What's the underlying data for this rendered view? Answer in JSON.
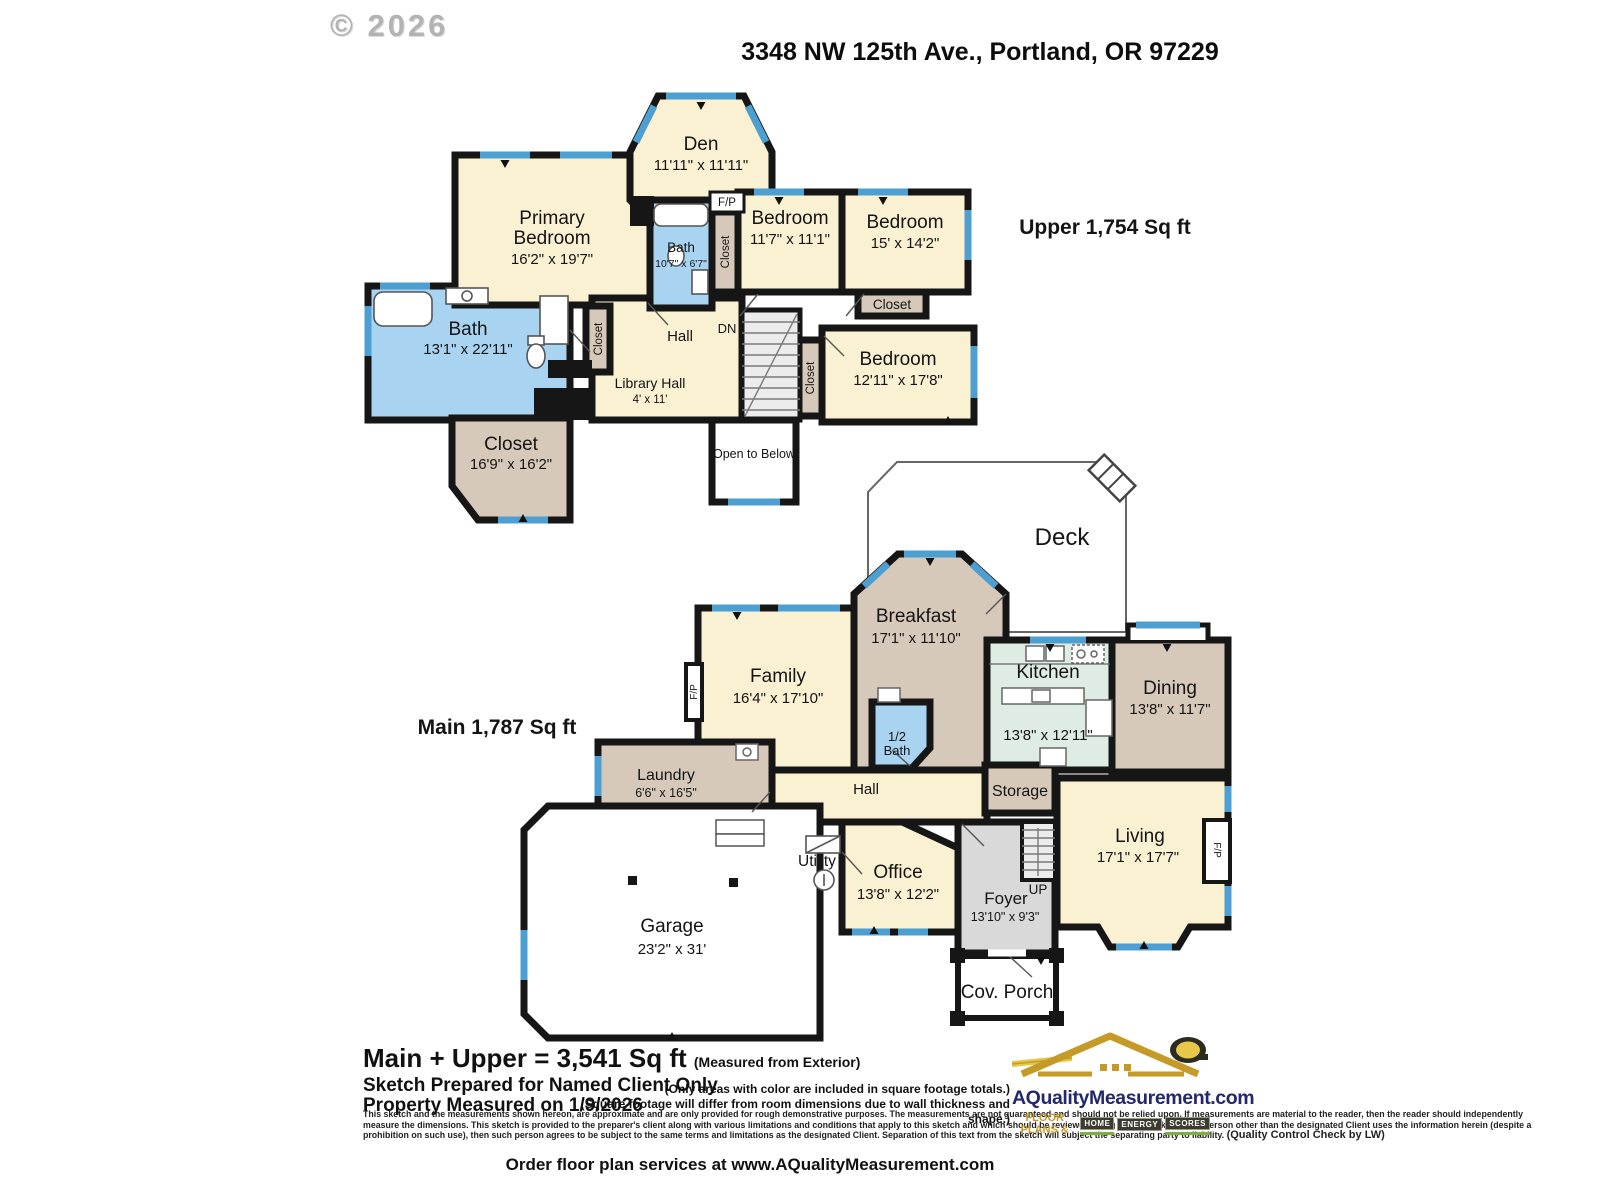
{
  "page": {
    "copyright": "© 2026",
    "address": "3348 NW 125th Ave., Portland, OR 97229",
    "order_line": "Order floor plan services at www.AQualityMeasurement.com"
  },
  "colors": {
    "room_cream": "#FAF0D2",
    "room_tan": "#D7C9B9",
    "room_blue": "#A9D4F1",
    "room_mint": "#DFECE3",
    "room_gray": "#D9D9D9",
    "stairs_gray": "#ECECEC",
    "window_blue": "#4E9FD1",
    "wall_black": "#161616",
    "logo_navy": "#23276B",
    "logo_gold": "#C59A27"
  },
  "upper": {
    "area_label": "Upper  1,754 Sq ft",
    "closet_label": "Closet",
    "dn_label": "DN",
    "fp_label": "F/P",
    "open_below": "Open to Below",
    "rooms": {
      "den": {
        "name": "Den",
        "dims": "11'11\" x 11'11\""
      },
      "primary": {
        "name1": "Primary",
        "name2": "Bedroom",
        "dims": "16'2\" x 19'7\""
      },
      "bath_small": {
        "name": "Bath",
        "dims": "10'7\" x 6'7\""
      },
      "bedroom1": {
        "name": "Bedroom",
        "dims": "11'7\" x 11'1\""
      },
      "bedroom2": {
        "name": "Bedroom",
        "dims": "15' x 14'2\""
      },
      "bedroom3": {
        "name": "Bedroom",
        "dims": "12'11\" x 17'8\""
      },
      "bath_big": {
        "name": "Bath",
        "dims": "13'1\" x 22'11\""
      },
      "hall": {
        "name": "Hall"
      },
      "library_hall": {
        "name": "Library Hall",
        "dims": "4' x 11'"
      },
      "walkin_closet": {
        "name": "Closet",
        "dims": "16'9\" x 16'2\""
      }
    }
  },
  "main": {
    "area_label": "Main  1,787 Sq ft",
    "up_label": "UP",
    "fp_label": "F/P",
    "rooms": {
      "deck": {
        "name": "Deck"
      },
      "breakfast": {
        "name": "Breakfast",
        "dims": "17'1\" x 11'10\""
      },
      "family": {
        "name": "Family",
        "dims": "16'4\" x 17'10\""
      },
      "kitchen": {
        "name": "Kitchen",
        "dims": "13'8\" x 12'11\""
      },
      "dining": {
        "name": "Dining",
        "dims": "13'8\" x 11'7\""
      },
      "half_bath": {
        "name1": "1/2",
        "name2": "Bath"
      },
      "laundry": {
        "name": "Laundry",
        "dims": "6'6\" x 16'5\""
      },
      "hall": {
        "name": "Hall"
      },
      "storage": {
        "name": "Storage"
      },
      "utility": {
        "name": "Utility"
      },
      "office": {
        "name": "Office",
        "dims": "13'8\" x 12'2\""
      },
      "foyer": {
        "name": "Foyer",
        "dims": "13'10\" x 9'3\""
      },
      "living": {
        "name": "Living",
        "dims": "17'1\" x 17'7\""
      },
      "garage": {
        "name": "Garage",
        "dims": "23'2\" x 31'"
      },
      "cov_porch": {
        "name": "Cov. Porch"
      }
    }
  },
  "footer": {
    "total": "Main + Upper = 3,541 Sq ft",
    "total_note": "(Measured from Exterior)",
    "prepared": "Sketch Prepared for Named Client Only",
    "measured": "Property Measured on 1/9/2026",
    "note1": "(Only areas with color are included in square footage totals.)",
    "note2": "(Square footage will differ from room dimensions due to wall thickness and shape.)",
    "fine_print": "This sketch and the measurements shown hereon, are approximate and are only provided for rough demonstrative purposes.  The measurements are not guaranteed and should not be relied upon.  If measurements are material to the reader, then the reader should independently measure the dimensions.  This sketch is provided to the preparer's client along with various limitations and conditions that apply to this sketch and which should be reviewed along with this sketch.  If a person other than the designated Client uses the information herein (despite a prohibition on such use), then such person agrees to be subject to the same terms and limitations as the designated Client.  Separation of this text from the sketch will subject the separating party to liability.  ",
    "qc": "(Quality Control Check by LW)"
  },
  "logo": {
    "domain": "AQualityMeasurement.com",
    "tagline_prefix": "FLOOR PLANS &",
    "badge1": "HOME",
    "badge2": "ENERGY",
    "badge3": "SCORES"
  }
}
